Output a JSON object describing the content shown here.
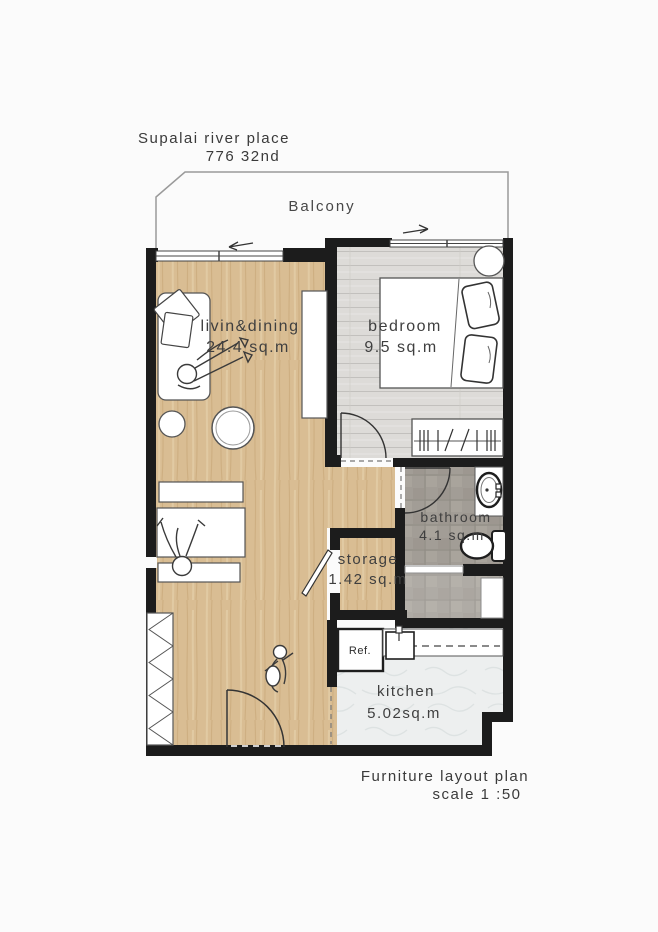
{
  "header": {
    "project": "Supalai river place",
    "unit": "776 32nd"
  },
  "balcony": {
    "label": "Balcony"
  },
  "rooms": {
    "living": {
      "label": "livin&dining",
      "area": "24.4 sq.m"
    },
    "bedroom": {
      "label": "bedroom",
      "area": "9.5 sq.m"
    },
    "bathroom": {
      "label": "bathroom",
      "area": "4.1 sq.m"
    },
    "storage": {
      "label": "storage",
      "area": "1.42 sq.m"
    },
    "kitchen": {
      "label": "kitchen",
      "area": "5.02sq.m"
    }
  },
  "appliances": {
    "fridge": "Ref."
  },
  "footer": {
    "title": "Furniture layout plan",
    "scale": "scale 1 :50"
  },
  "colors": {
    "wall": "#1c1c1c",
    "wood_floor": "#d9bd93",
    "bedroom_floor": "#dddbd8",
    "bathroom_tile": "#a29d96",
    "kitchen_floor": "#edefef",
    "outline": "#4a4a4a",
    "text": "#3f3f3f",
    "paper": "#fbfbfb"
  }
}
